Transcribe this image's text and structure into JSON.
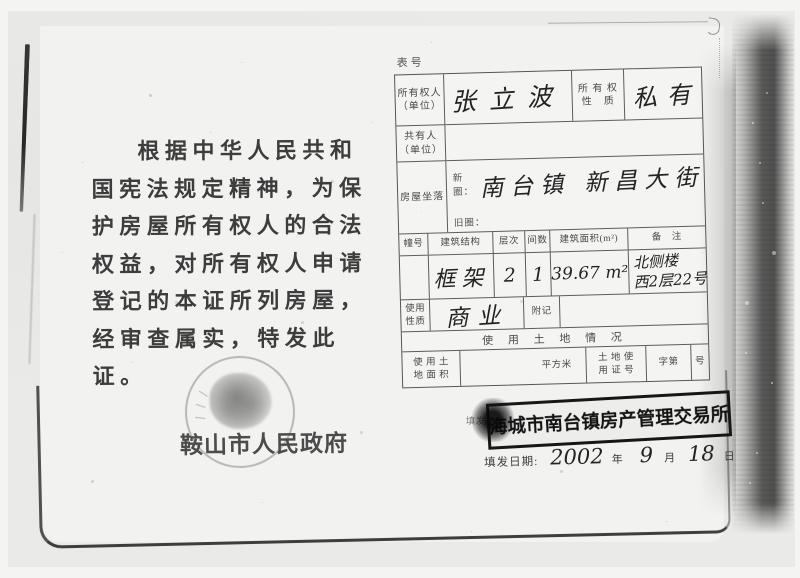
{
  "left_page": {
    "paragraph": [
      "根据中华人民共和",
      "国宪法规定精神，为保",
      "护房屋所有权人的合法",
      "权益，对所有权人申请",
      "登记的本证所列房屋，",
      "经审查属实，特发此证。"
    ],
    "seal_text": "鞍山市人民政府"
  },
  "right_page": {
    "form_no_label": "表号",
    "owner_row": {
      "label": "所有权人",
      "label_sub": "（单位）",
      "value": "张立波",
      "nature_label_line1": "所 有 权",
      "nature_label_line2": "性　质",
      "nature_value": "私有"
    },
    "coowner_row": {
      "label": "共有人",
      "label_sub": "（单位）"
    },
    "location_row": {
      "label": "房屋坐落",
      "new_label": "新圈：",
      "new_value": "南台镇 新昌大街",
      "old_label": "旧圈："
    },
    "building_header": {
      "no": "幢号",
      "structure": "建筑结构",
      "floors": "层次",
      "rooms": "间数",
      "area": "建筑面积(m²)",
      "remark": "备　注"
    },
    "building_row": {
      "structure": "框架",
      "floors": "2",
      "rooms": "1",
      "area": "39.67 m²",
      "remark_line1": "北侧楼",
      "remark_line2": "西2层22号"
    },
    "use_row": {
      "label_line1": "使用",
      "label_line2": "性质",
      "value": "商业",
      "appendix_label": "附记"
    },
    "land_section_title": "使 用 土 地 情 况",
    "land_row": {
      "label_line1": "使 用 土",
      "label_line2": "地 面 积",
      "unit": "平方米",
      "cert_label_line1": "土 地 使",
      "cert_label_line2": "用 证 号",
      "serial_prefix": "字第",
      "serial_suffix": "号"
    },
    "issuer_label": "填发机关",
    "stamp_text": "海城市南台镇房产管理交易所",
    "date_row": {
      "label": "填发日期:",
      "year": "2002",
      "year_unit": "年",
      "month": "9",
      "month_unit": "月",
      "day": "18",
      "day_unit": "日"
    }
  }
}
